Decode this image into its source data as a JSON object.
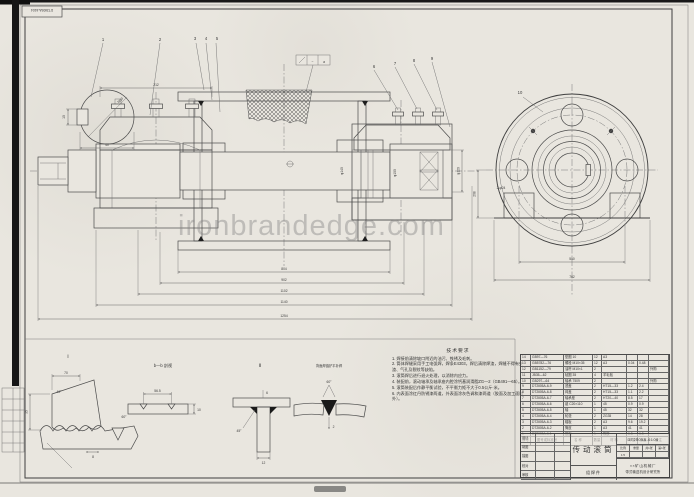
{
  "stamp": {
    "code": "DT2Ⅱ05A-6104"
  },
  "watermark": {
    "text": "ironbrandedge.com"
  },
  "main_view": {
    "callouts": [
      "1",
      "2",
      "3",
      "4",
      "5",
      "6",
      "7",
      "8",
      "9"
    ],
    "surface_mid": "~",
    "surface_right": "a",
    "dims_bottom": [
      "804",
      "902",
      "1102",
      "1140",
      "1254"
    ],
    "dim_bearing_span": "212",
    "dim_shaft_dia": "φ120",
    "dim_hub_dia": "φ140",
    "dim_bore_dia": "φ100",
    "detail_circle": {
      "thread": "M10",
      "width": "40",
      "height": "10"
    }
  },
  "end_view": {
    "callout": "10",
    "dim_feet_span": "550",
    "dim_base_width": "762",
    "dim_height": "208",
    "dim_holes": "2-φ24"
  },
  "details": {
    "d1_label": "Ⅰ",
    "d1_dim_top": "70",
    "d1_angle1": "40°",
    "d1_angle2": "60°",
    "d1_dim_depth": "35",
    "d1_dim_pitch": "8",
    "bb_label": "b—b 剖视",
    "bb_dim_top": "56.5",
    "bb_dim_right": "10",
    "d2_label": "Ⅱ",
    "d2_angle": "45°",
    "d2_dim_top": "6",
    "d2_dim_bottom": "12",
    "bw_label": "背面焊缝铲平补焊",
    "bw_angle": "60°",
    "bw_gap": "2"
  },
  "notes": {
    "title": "技术要求",
    "items": [
      "1. 焊接前清除坡口附近的油污、铁锈及毛刺。",
      "2. 筒体焊缝采用手工电弧焊，焊条E4303，焊后清除焊渣，焊缝不得有夹渣、气孔及裂纹等缺陷。",
      "3. 滚筒焊后进行退火处理，以消除内应力。",
      "4. 装配前，滚动轴承及轴承座内腔涂钙基润滑脂ZG—2（GB491—65）。",
      "5. 滚筒装配后作静平衡试验，不平衡力矩不大于0.5公斤·米。",
      "6. 内表面涂红丹防锈漆两道，外表面涂灰色调和漆两道（胶面及加工面除外）。"
    ]
  },
  "parts_table": {
    "header": [
      "序号",
      "图号或标准号",
      "名  称",
      "数量",
      "材  料",
      "单重",
      "总重",
      "备注"
    ],
    "rows": [
      [
        "14",
        "GB97—76",
        "垫圈 10",
        "12",
        "A3",
        "",
        "",
        ""
      ],
      [
        "13",
        "GB5782—76",
        "螺栓 M10×35",
        "12",
        "A3",
        "0.04",
        "0.48",
        ""
      ],
      [
        "12",
        "GB1152—79",
        "油杯 M10×1",
        "2",
        "",
        "",
        "",
        "外购"
      ],
      [
        "11",
        "JB35—62",
        "毡圈 35",
        "4",
        "羊毛毡",
        "",
        "",
        ""
      ],
      [
        "10",
        "GB297—64",
        "轴承 7509",
        "2",
        "",
        "",
        "",
        "外购"
      ],
      [
        "9",
        "DT2Ⅱ05A-6-9",
        "透盖",
        "2",
        "HT15—33",
        "1.2",
        "2.4",
        ""
      ],
      [
        "8",
        "DT2Ⅱ05A-6-8",
        "闷盖",
        "2",
        "HT15—33",
        "1.1",
        "2.2",
        ""
      ],
      [
        "7",
        "DT2Ⅱ05A-6-7",
        "轴承座",
        "2",
        "HT20—40",
        "8.5",
        "17",
        ""
      ],
      [
        "6",
        "DT2Ⅱ05A-6-6",
        "键 C20×110",
        "1",
        "45",
        "0.9",
        "0.9",
        ""
      ],
      [
        "5",
        "DT2Ⅱ05A-6-5",
        "轴",
        "1",
        "45",
        "32",
        "32",
        ""
      ],
      [
        "4",
        "DT2Ⅱ05A-6-4",
        "轮毂",
        "2",
        "ZG35",
        "14",
        "28",
        ""
      ],
      [
        "3",
        "DT2Ⅱ05A-6-3",
        "辐板",
        "2",
        "A3",
        "9.6",
        "19.2",
        ""
      ],
      [
        "2",
        "DT2Ⅱ05A-6-2",
        "筒皮",
        "1",
        "A3",
        "41",
        "41",
        ""
      ],
      [
        "1",
        "DT2Ⅱ05A-6-1",
        "胶面",
        "1",
        "橡胶",
        "6.8",
        "6.8",
        ""
      ]
    ]
  },
  "title_block": {
    "title": "传动滚筒",
    "drawing_no": "DT2Ⅱ05A-6104",
    "type_label": "组焊件",
    "scale_label": "比例",
    "scale_value": "1:5",
    "weight_label": "重量",
    "weight_value": "",
    "sheet_total": "共1张",
    "sheet_no": "第1张",
    "org_line1": "××矿山机械厂",
    "org_line2": "带式输送机设计研究所",
    "sign_rows": [
      [
        "设计",
        ""
      ],
      [
        "制图",
        ""
      ],
      [
        "描图",
        ""
      ],
      [
        "校对",
        ""
      ],
      [
        "审核",
        ""
      ]
    ]
  }
}
